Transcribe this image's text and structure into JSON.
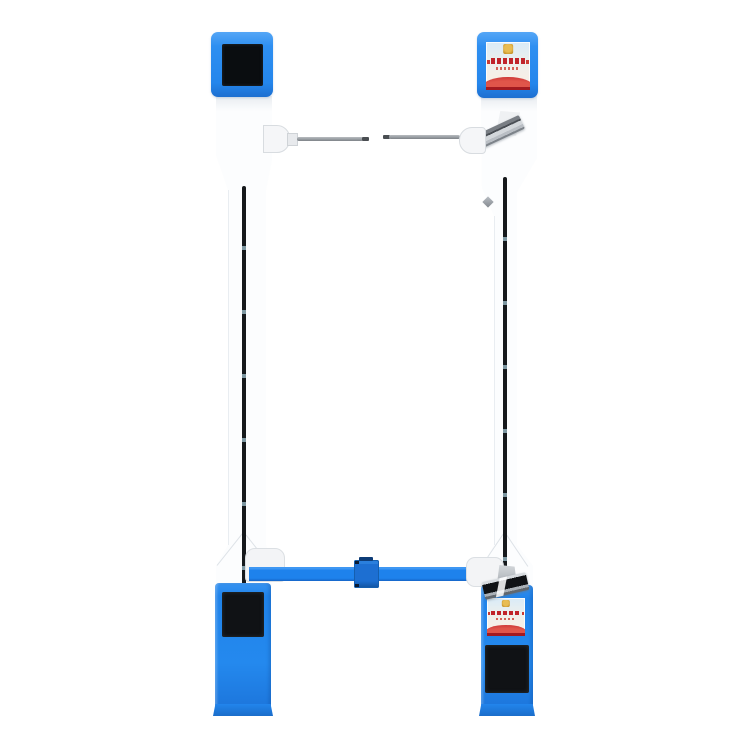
{
  "window": {
    "width": 750,
    "height": 750
  },
  "scene": {
    "type": "product-photo",
    "subject": "dual-pillar pedestrian access-control barrier gate",
    "background": "plain white, no visible text or watermark",
    "states": {
      "left_top_screen": "blank (off, black)",
      "right_top_screen": "welcome poster displayed",
      "left_pedestal_panel": "blank (black)",
      "right_pedestal_screen": "welcome poster displayed",
      "right_pedestal_panel": "blank (black)"
    }
  },
  "colors": {
    "background": "#ffffff",
    "blue_bright": "#2e8ff1",
    "blue_light_edge": "#55a6f6",
    "blue_dark": "#1d6fd0",
    "beam_blue": "#1e82ec",
    "hinge_mid": "#1d6fd2",
    "hinge_dark": "#12539e",
    "pedestal_blue": "#2489ee",
    "pedestal_dark": "#1666c8",
    "white_part": "#fcfdfe",
    "screen_black": "#0a0d10",
    "panel_black": "#101215",
    "strip_dark": "#16191c",
    "strip_window": "#7e98a2",
    "arm_gray": "#989da2",
    "arm_tip": "#4a4e52",
    "poster_sky": "#d9ebf8",
    "poster_cream": "#f5efe7",
    "poster_gold": "#e8bc52",
    "poster_red": "#c0242a",
    "poster_red_dark": "#a31a20"
  },
  "parts": {
    "left_pillar": [
      "top display box (blue, black screen)",
      "white column",
      "vertical infrared sensor strip",
      "IR arm with mount",
      "blue pedestal with black panel"
    ],
    "right_pillar": [
      "top display box (blue, poster screen)",
      "angled card/QR scanner (top)",
      "white column with small diamond sensor",
      "vertical infrared sensor strip",
      "angled scanner above pedestal",
      "blue pedestal with poster screen and black panel"
    ],
    "barrier": [
      "two facing IR arms with center gap (top)",
      "blue barrier beam with center hinge block (bottom)"
    ]
  },
  "poster_content": {
    "emblem": "gold national-style emblem at top center",
    "title": "row of red Chinese characters (illegible at this size)",
    "subtitle": "smaller red text line (illegible)",
    "banner": "red curtain / stage graphic across the bottom"
  }
}
